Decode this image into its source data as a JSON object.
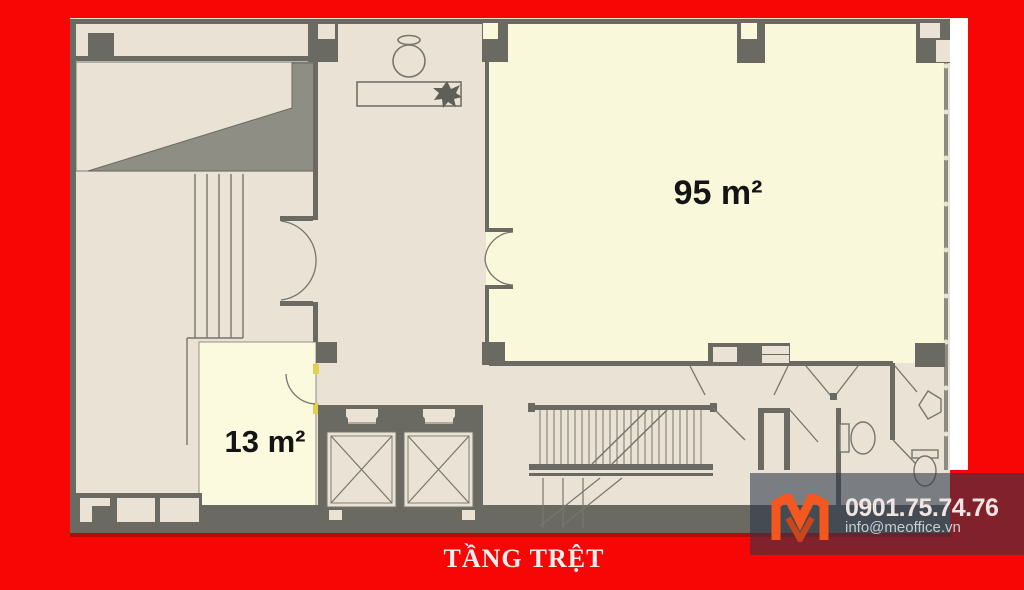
{
  "page": {
    "background_color": "#f80606"
  },
  "floor_plan": {
    "title": "TẦNG TRỆT",
    "rooms": [
      {
        "id": "main-room",
        "area_label": "95 m²"
      },
      {
        "id": "small-room",
        "area_label": "13 m²"
      }
    ],
    "features": [
      "entrance-ramp",
      "upper-staircase",
      "lobby",
      "reception-desk",
      "plant",
      "vase",
      "double-door-lobby",
      "double-door-main-room",
      "entrance-columns",
      "elevator-shaft-1",
      "elevator-shaft-2",
      "small-room-door",
      "main-staircase",
      "bathroom",
      "toilet",
      "toilet",
      "sink",
      "window-wall"
    ],
    "colors": {
      "floor_beige": "#eae2d4",
      "room_cream": "#faf8db",
      "wall_dark": "#6a6a62",
      "ramp_gray": "#8e8e84",
      "door_jamb_yellow": "#e3cf52"
    }
  },
  "watermark": {
    "logo": "meoffice-logo",
    "logo_color": "#f4581f",
    "phone": "0901.75.74.76",
    "email": "info@meoffice.vn",
    "band_color": "rgba(42,53,73,0.58)"
  }
}
